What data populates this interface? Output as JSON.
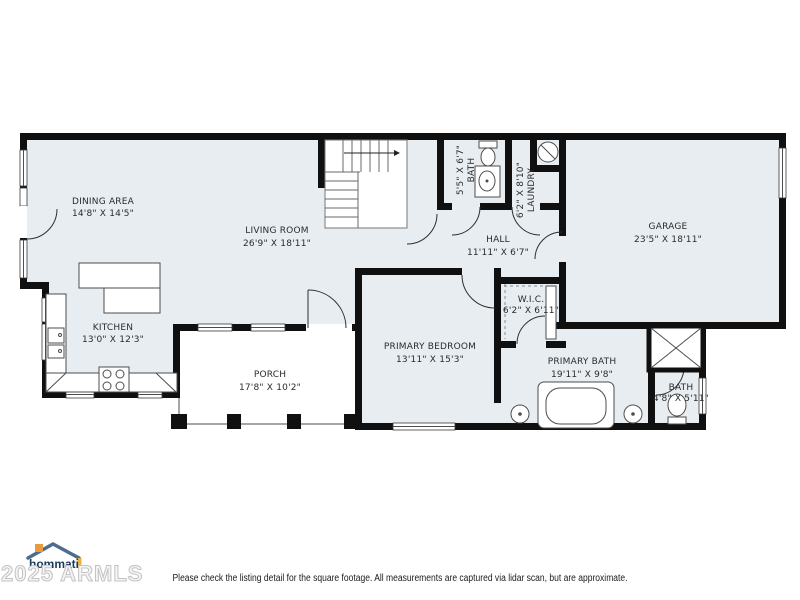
{
  "rooms": [
    {
      "id": "dining",
      "name": "DINING AREA",
      "dims": "14'8\" X 14'5\""
    },
    {
      "id": "living",
      "name": "LIVING ROOM",
      "dims": "26'9\" X 18'11\""
    },
    {
      "id": "kitchen",
      "name": "KITCHEN",
      "dims": "13'0\" X 12'3\""
    },
    {
      "id": "porch",
      "name": "PORCH",
      "dims": "17'8\" X 10'2\""
    },
    {
      "id": "primary-bedroom",
      "name": "PRIMARY BEDROOM",
      "dims": "13'11\" X 15'3\""
    },
    {
      "id": "hall",
      "name": "HALL",
      "dims": "11'11\" X 6'7\""
    },
    {
      "id": "bath",
      "name": "BATH",
      "dims": "5'5\" X 6'7\""
    },
    {
      "id": "laundry",
      "name": "LAUNDRY",
      "dims": "6'2\" X 8'10\""
    },
    {
      "id": "wic",
      "name": "W.I.C.",
      "dims": "6'2\" X 6'11\""
    },
    {
      "id": "primary-bath",
      "name": "PRIMARY BATH",
      "dims": "19'11\" X 9'8\""
    },
    {
      "id": "bath-2",
      "name": "BATH",
      "dims": "4'8\" X 5'11\""
    },
    {
      "id": "garage",
      "name": "GARAGE",
      "dims": "23'5\" X 18'11\""
    }
  ],
  "footer": {
    "disclaimer": "Please check the listing detail for the square footage. All measurements are captured via lidar scan, but are approximate.",
    "watermark": "2025 ARMLS",
    "logo_text": "hommati"
  },
  "palette": {
    "wall": "#101010",
    "room_fill": "#e8edf1",
    "logo_navy": "#173a5e",
    "logo_orange": "#e89b3e",
    "watermark_gray": "#c3c3c3"
  }
}
